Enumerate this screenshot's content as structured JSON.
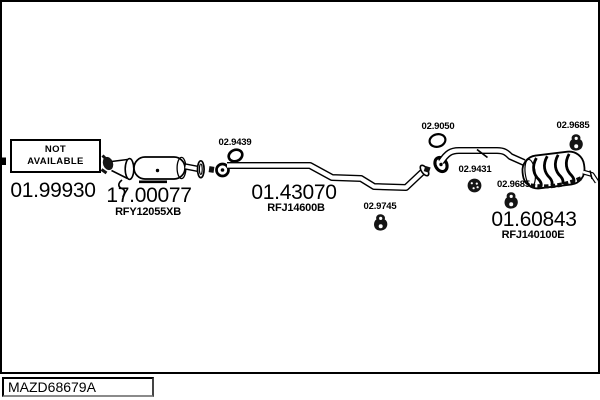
{
  "page": {
    "background": "#ffffff",
    "line_color": "#000000"
  },
  "footer": {
    "code": "MAZD68679A"
  },
  "not_available_box": {
    "line1": "NOT",
    "line2": "AVAILABLE"
  },
  "parts": {
    "front_pipe": {
      "number": "01.99930",
      "note": "shown as NOT AVAILABLE box"
    },
    "catalyst": {
      "number": "17.00077",
      "ref": "RFY12055XB"
    },
    "centre_pipe": {
      "number": "01.43070",
      "ref": "RFJ14600B"
    },
    "rear_silencer": {
      "number": "01.60843",
      "ref": "RFJ140100E"
    }
  },
  "fittings": {
    "hanger_front": {
      "number": "02.9439"
    },
    "hanger_centre": {
      "number": "02.9745"
    },
    "gasket_rear_joint": {
      "number": "02.9050"
    },
    "grommet_rear": {
      "number": "02.9431"
    },
    "hanger_rear_mid": {
      "number": "02.9685"
    },
    "hanger_tail": {
      "number": "02.9685"
    }
  }
}
